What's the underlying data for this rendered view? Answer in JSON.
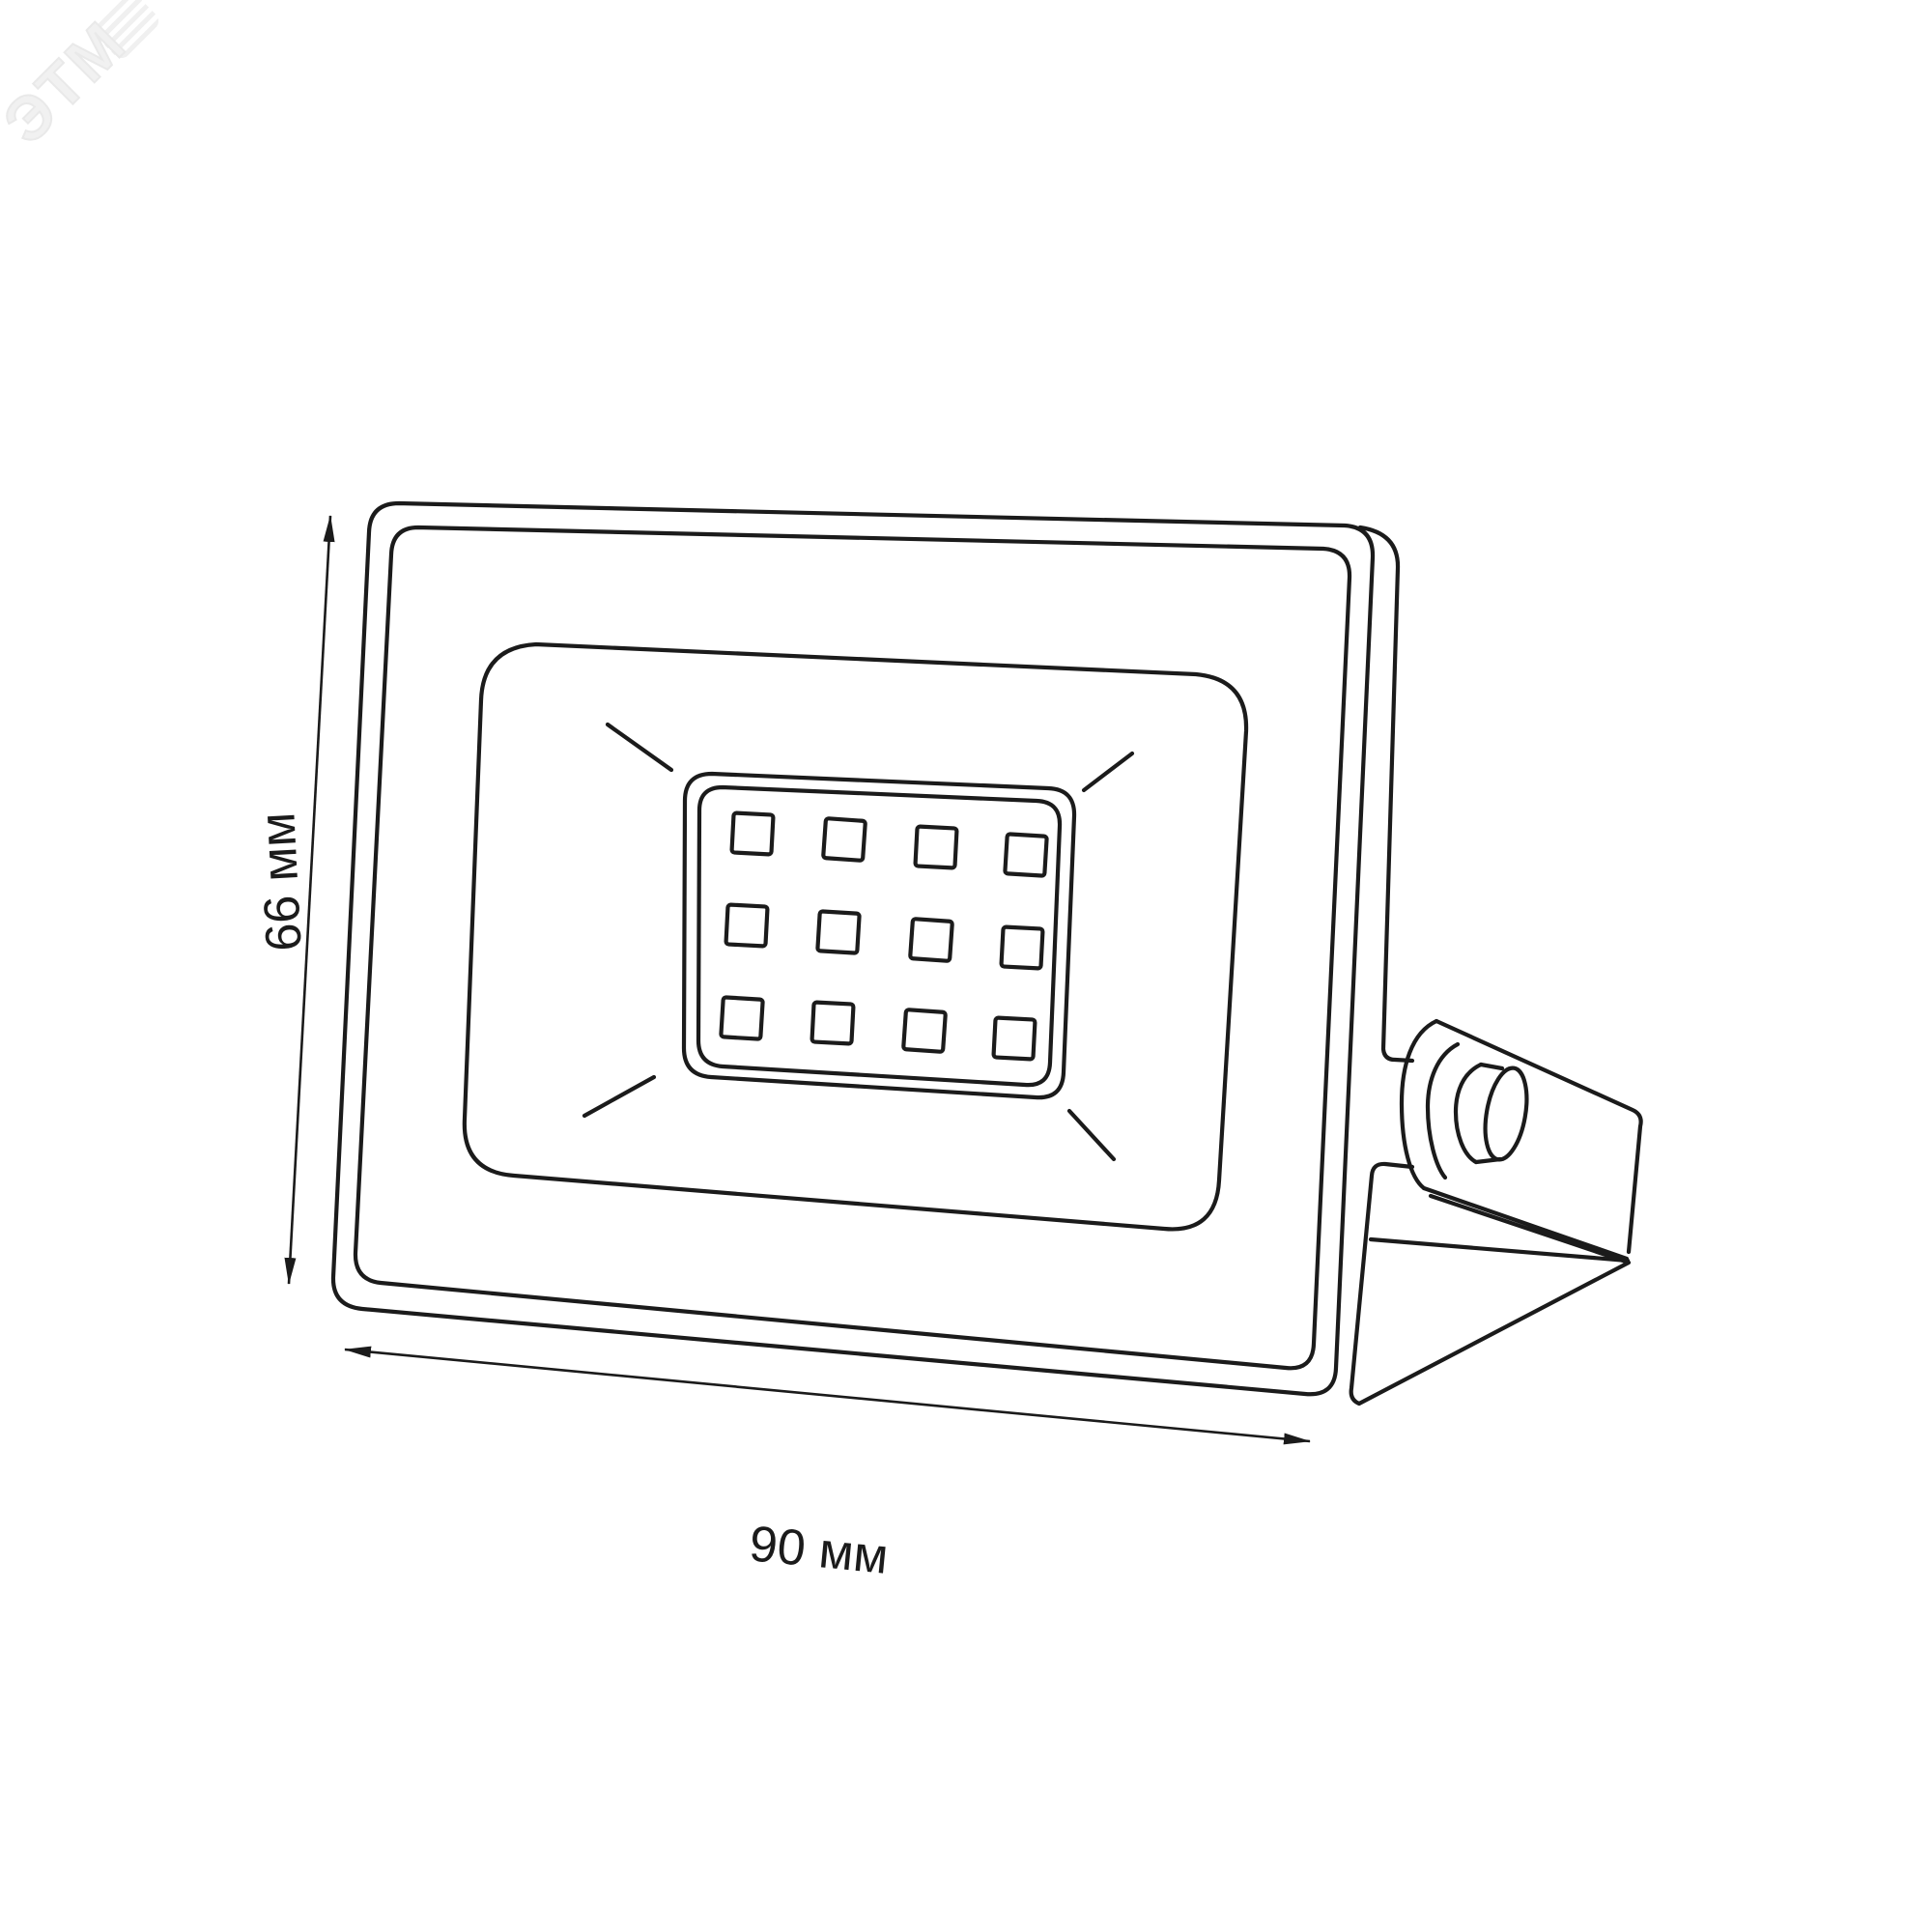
{
  "watermark": {
    "text": "ЭТМ"
  },
  "dimensions": {
    "height": {
      "label": "66 мм",
      "value": 66,
      "unit": "мм"
    },
    "width": {
      "label": "90 мм",
      "value": 90,
      "unit": "мм"
    }
  },
  "drawing": {
    "led_grid": {
      "rows": 3,
      "columns": 4,
      "count": 12
    },
    "colors": {
      "line": "#1b1b1b",
      "background": "#ffffff",
      "watermark": "#ededed"
    }
  }
}
